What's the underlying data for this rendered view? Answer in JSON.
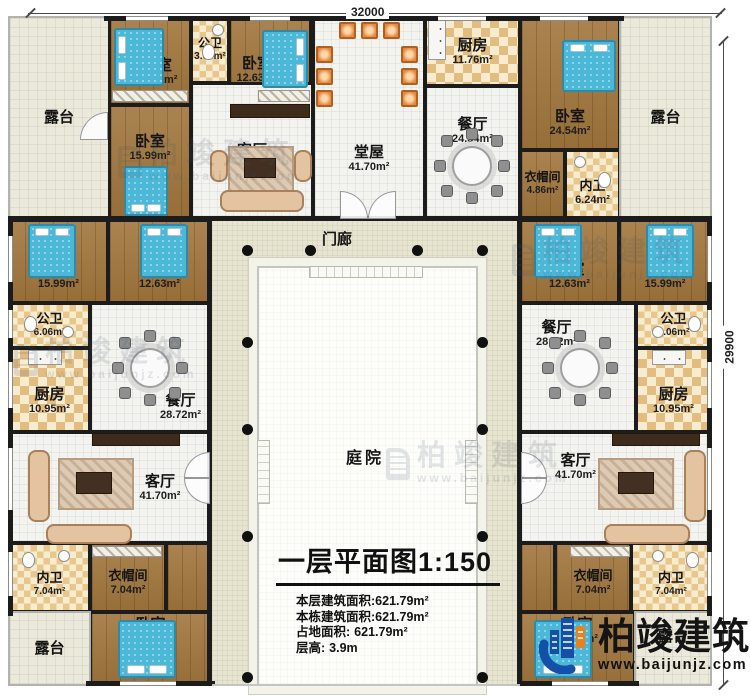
{
  "dimensions": {
    "top": "32000",
    "right": "29900"
  },
  "labels": {
    "porch": "门廊",
    "courtyard": "庭院"
  },
  "rooms": {
    "terrace_tl": {
      "name": "露台"
    },
    "bed_t1": {
      "name": "卧室",
      "area": "12.63m²"
    },
    "bath_t1": {
      "name": "公卫",
      "area": "3.68m²"
    },
    "bed_t2": {
      "name": "卧室",
      "area": "12.63m²"
    },
    "bed_t3": {
      "name": "卧室",
      "area": "15.99m²"
    },
    "living_t": {
      "name": "客厅",
      "area": "24.56m²"
    },
    "hall": {
      "name": "堂屋",
      "area": "41.70m²"
    },
    "kitchen_t": {
      "name": "厨房",
      "area": "11.76m²"
    },
    "dining_t": {
      "name": "餐厅",
      "area": "24.54m²"
    },
    "bed_t4": {
      "name": "卧室",
      "area": "24.54m²"
    },
    "cloak_t": {
      "name": "衣帽间",
      "area": "4.86m²"
    },
    "bath_t2": {
      "name": "内卫",
      "area": "6.24m²"
    },
    "terrace_tr": {
      "name": "露台"
    },
    "bed_l1": {
      "name": "卧室",
      "area": "15.99m²"
    },
    "bed_l2": {
      "name": "卧室",
      "area": "12.63m²"
    },
    "bath_l1": {
      "name": "公卫",
      "area": "6.06m²"
    },
    "kitchen_l": {
      "name": "厨房",
      "area": "10.95m²"
    },
    "dining_l": {
      "name": "餐厅",
      "area": "28.72m²"
    },
    "living_l": {
      "name": "客厅",
      "area": "41.70m²"
    },
    "bath_l2": {
      "name": "内卫",
      "area": "7.04m²"
    },
    "cloak_l": {
      "name": "衣帽间",
      "area": "7.04m²"
    },
    "bed_l3": {
      "name": "卧室",
      "area": "25.05m²"
    },
    "terrace_bl": {
      "name": "露台"
    },
    "bed_r1": {
      "name": "卧室",
      "area": "12.63m²"
    },
    "bed_r2": {
      "name": "卧室",
      "area": "15.99m²"
    },
    "bath_r1": {
      "name": "公卫",
      "area": "6.06m²"
    },
    "dining_r": {
      "name": "餐厅",
      "area": "28.72m²"
    },
    "kitchen_r": {
      "name": "厨房",
      "area": "10.95m²"
    },
    "living_r": {
      "name": "客厅",
      "area": "41.70m²"
    },
    "cloak_r": {
      "name": "衣帽间",
      "area": "7.04m²"
    },
    "bath_r2": {
      "name": "内卫",
      "area": "7.04m²"
    },
    "bed_r3": {
      "name": "卧室",
      "area": "25.05m²"
    },
    "terrace_br": {
      "name": "露台"
    }
  },
  "title_block": {
    "title": "一层平面图",
    "scale": "1:150",
    "stats": [
      {
        "label": "本层建筑面积:",
        "value": "621.79m²"
      },
      {
        "label": "本栋建筑面积:",
        "value": "621.79m²"
      },
      {
        "label": "占地面积:",
        "value": "621.79m²"
      },
      {
        "label": "层高:",
        "value": "3.9m"
      }
    ]
  },
  "watermark": {
    "text": "柏竣建筑",
    "url": "www.baijunjz.com"
  },
  "logo": {
    "name": "柏竣建筑",
    "url": "www.baijunjz.com"
  },
  "colors": {
    "wall": "#1c1c1c",
    "wood_floor": "#a0753c",
    "bed": "#4cb8d8",
    "checker_tan": "#e3bd80",
    "logo_blue": "#1550a8",
    "logo_orange": "#e8821e"
  }
}
